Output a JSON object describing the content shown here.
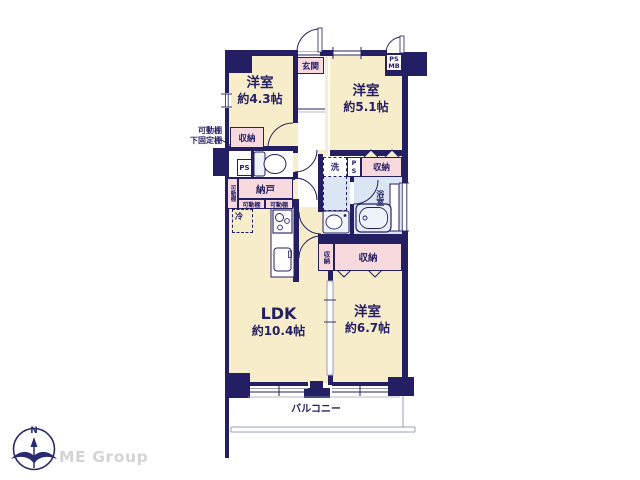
{
  "plan": {
    "rooms": {
      "western1": {
        "name": "洋室",
        "size": "約4.3帖"
      },
      "western2": {
        "name": "洋室",
        "size": "約5.1帖"
      },
      "western3": {
        "name": "洋室",
        "size": "約6.7帖"
      },
      "ldk": {
        "name": "LDK",
        "size": "約10.4帖"
      },
      "entrance": {
        "name": "玄関"
      },
      "storeroom": {
        "name": "納戸"
      },
      "bathroom": {
        "name": "浴室"
      },
      "balcony": {
        "name": "バルコニー"
      }
    },
    "labels": {
      "closet": "収納",
      "movable_shelf": "可動棚",
      "shelf_note1": "可動棚",
      "shelf_note2": "下固定棚",
      "fridge": "冷",
      "washer": "洗",
      "ps": "PS",
      "mb": "MB"
    },
    "colors": {
      "wall": "#241f63",
      "room_floor": "#f8edcb",
      "closet_fill": "#f8d9de",
      "wet_area": "#dbe6f4",
      "text": "#241f63",
      "balcony_line": "#9aa0b8"
    }
  },
  "branding": {
    "company": "ME Group",
    "compass_north": "N",
    "company_color": "#d4d4d4"
  }
}
